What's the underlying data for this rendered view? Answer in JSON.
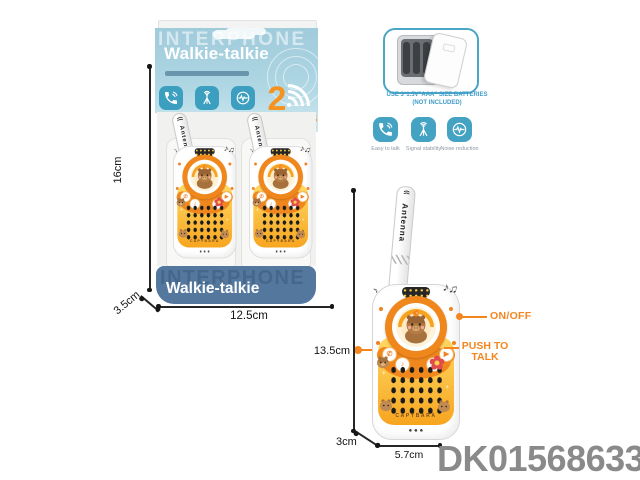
{
  "product_code": "DK01568633",
  "box_front": {
    "brand": "INTERPHONE",
    "product_name": "Walkie-talkie",
    "features": [
      {
        "icon": "phone-icon",
        "label": "Easy to talk"
      },
      {
        "icon": "antenna-icon",
        "label": "Signal stability"
      },
      {
        "icon": "noise-icon",
        "label": "Noise reduction"
      }
    ],
    "channels_number": "2",
    "channels_label": "CHANNELS",
    "channels_sub": "SAFE COMMUNICATION",
    "bottom_brand": "INTERPHONE",
    "bottom_product_name": "Walkie-talkie"
  },
  "battery_info": {
    "line1": "USE 3*1.5V\"AAA\" SIZE BATTERIES",
    "line2": "(NOT INCLUDED)"
  },
  "feature_list": [
    {
      "icon": "phone-icon",
      "label": "Easy to talk"
    },
    {
      "icon": "antenna-icon",
      "label": "Signal stability"
    },
    {
      "icon": "noise-icon",
      "label": "Noise reduction"
    }
  ],
  "device": {
    "antenna_label": "Antenna",
    "brand_text": "CAPYBARA",
    "music_notes": "♪♫",
    "left_note": "♪",
    "buttons": {
      "call": "✆",
      "music": "♪",
      "up": "▲",
      "play": "▶"
    },
    "on_off_label": "ON/OFF",
    "push_to_talk_line1": "PUSH TO",
    "push_to_talk_line2": "TALK"
  },
  "dimensions": {
    "box_height": "16cm",
    "box_depth": "3.5cm",
    "box_width": "12.5cm",
    "device_height": "13.5cm",
    "device_depth": "3cm",
    "device_width": "5.7cm"
  },
  "colors": {
    "accent_orange": "#f5861f",
    "teal": "#41a0bf",
    "band_blue": "#a6cfdd",
    "bottom_band_blue": "#54779e",
    "code_gray": "#8a8a8a"
  }
}
